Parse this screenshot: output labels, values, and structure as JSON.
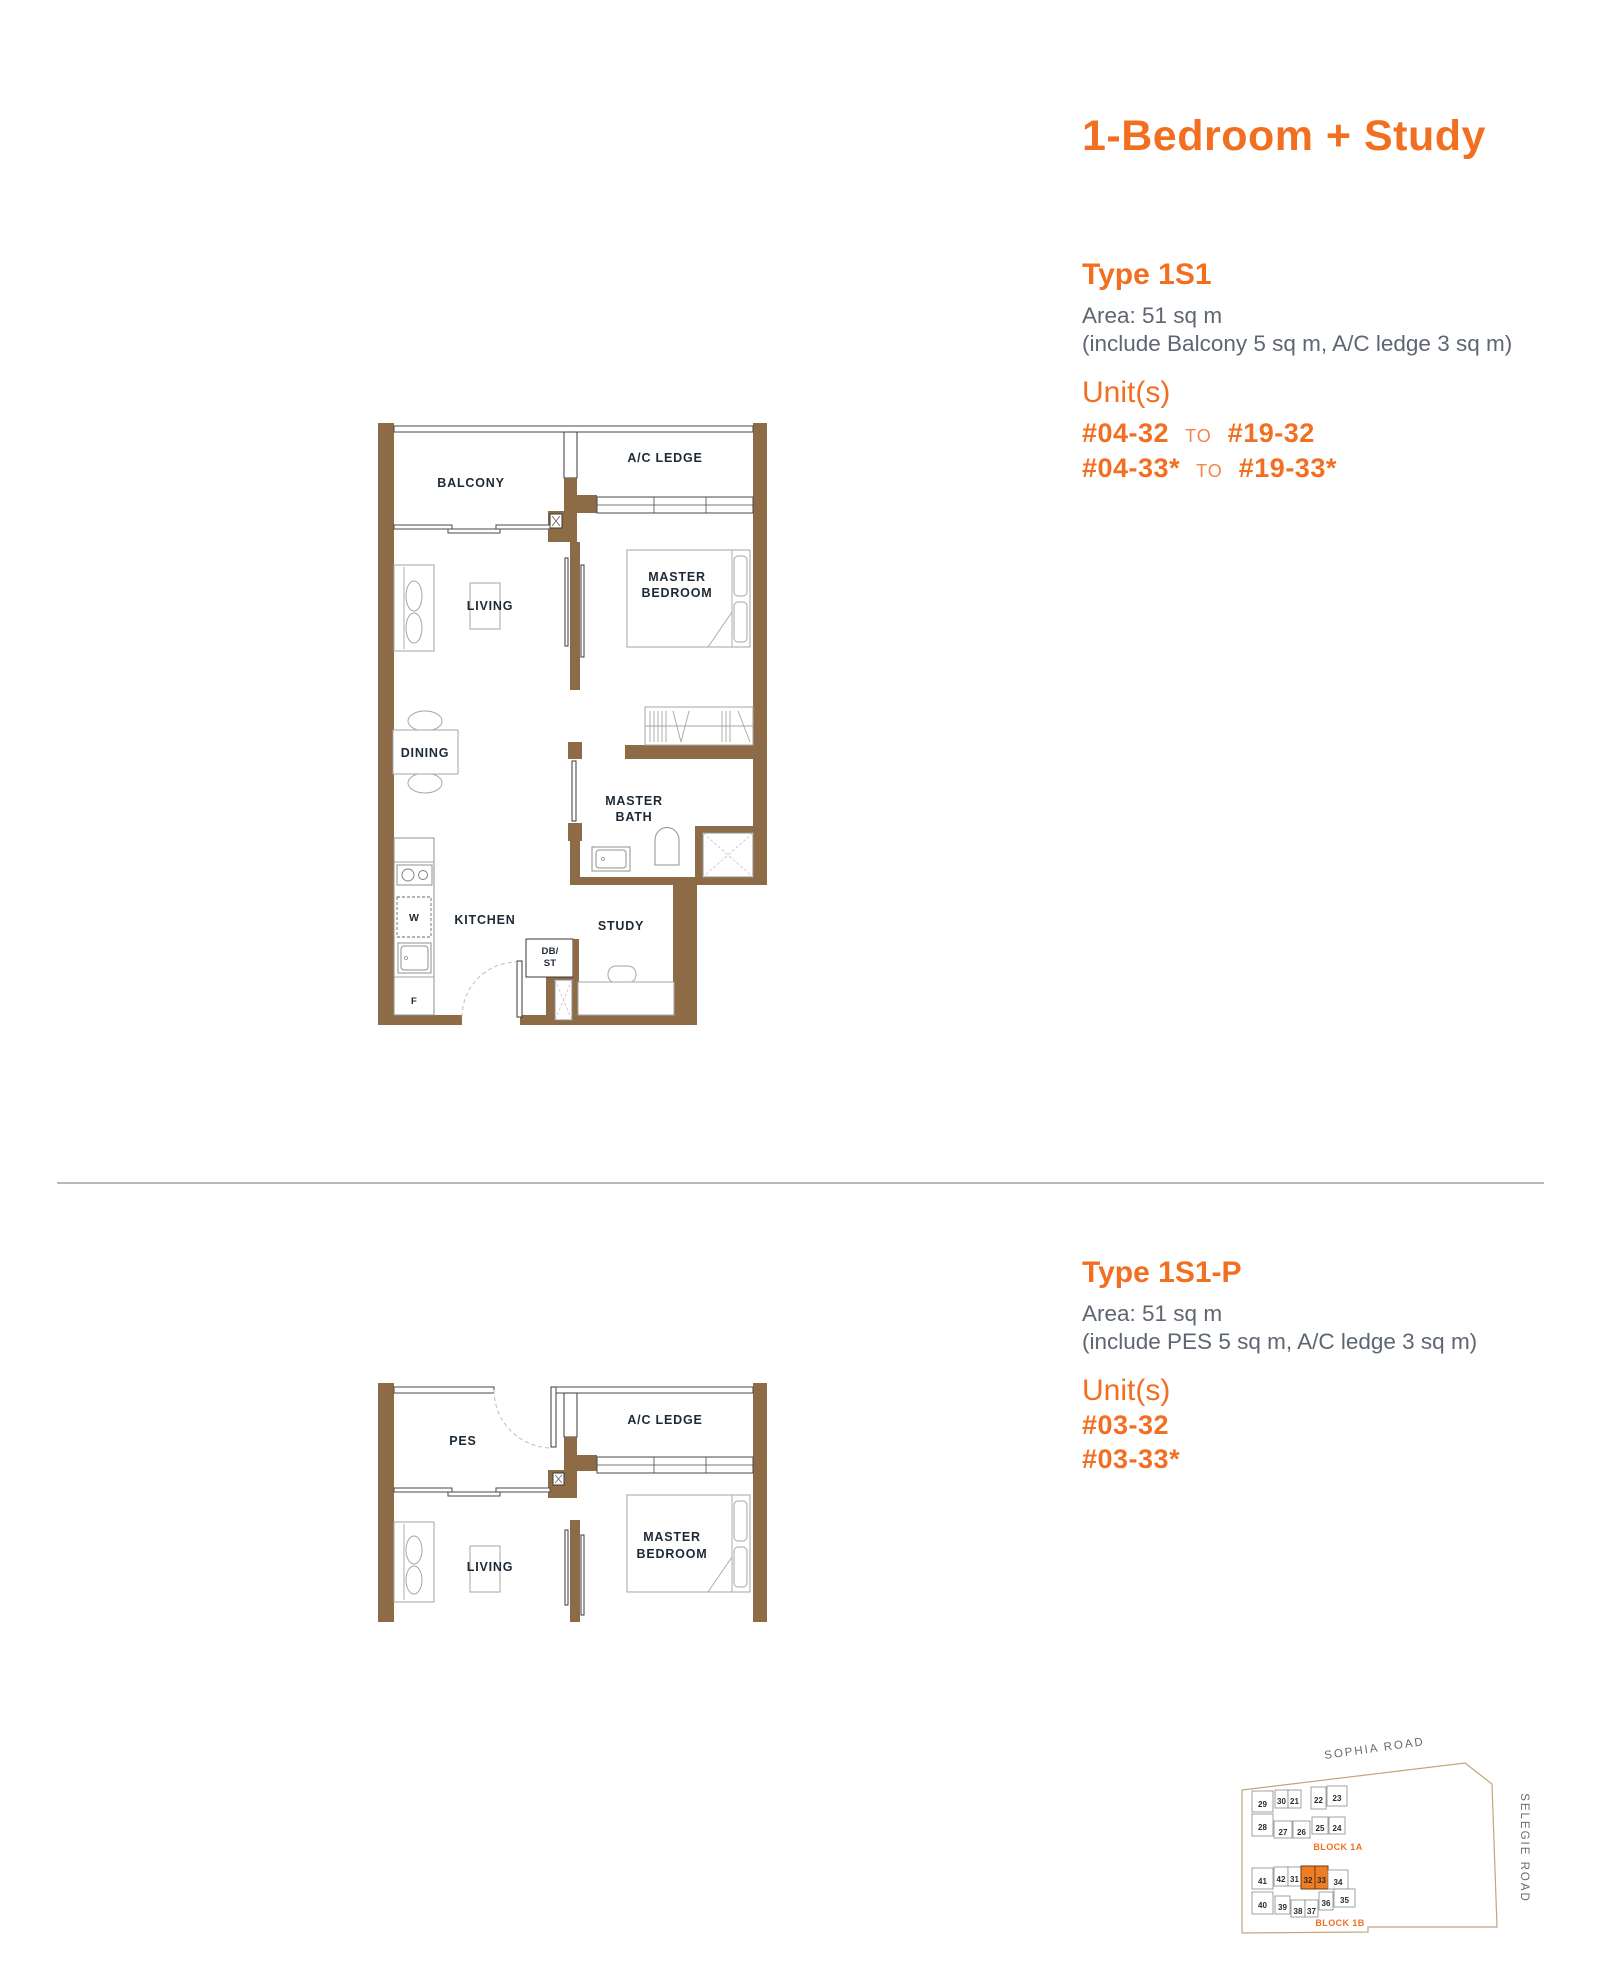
{
  "page": {
    "title": "1-Bedroom + Study"
  },
  "colors": {
    "accent_orange": "#f26f21",
    "wall_brown": "#8d6b46",
    "body_gray": "#5d6672",
    "plan_label": "#1d2a36",
    "highlight_unit": "#ef7d23"
  },
  "type1": {
    "heading": "Type 1S1",
    "area_line1": "Area: 51 sq m",
    "area_line2": "(include Balcony 5 sq m, A/C ledge 3 sq m)",
    "units_heading": "Unit(s)",
    "unit_rows": [
      {
        "from": "#04-32",
        "to_word": "TO",
        "to": "#19-32"
      },
      {
        "from": "#04-33*",
        "to_word": "TO",
        "to": "#19-33*"
      }
    ]
  },
  "type2": {
    "heading": "Type 1S1-P",
    "area_line1": "Area: 51 sq m",
    "area_line2": "(include PES 5 sq m, A/C ledge 3 sq m)",
    "units_heading": "Unit(s)",
    "unit_rows": [
      {
        "from": "#03-32"
      },
      {
        "from": "#03-33*"
      }
    ]
  },
  "plan1": {
    "balcony": "BALCONY",
    "ac_ledge": "A/C LEDGE",
    "living": "LIVING",
    "master_line1": "MASTER",
    "master_line2": "BEDROOM",
    "dining": "DINING",
    "bath_line1": "MASTER",
    "bath_line2": "BATH",
    "kitchen": "KITCHEN",
    "study": "STUDY",
    "db_line1": "DB/",
    "db_line2": "ST",
    "washer": "W",
    "fridge": "F"
  },
  "plan2": {
    "pes": "PES",
    "ac_ledge": "A/C LEDGE",
    "living": "LIVING",
    "master_line1": "MASTER",
    "master_line2": "BEDROOM"
  },
  "sitemap": {
    "road_top": "SOPHIA ROAD",
    "road_right": "SELEGIE ROAD",
    "block_1a": {
      "label": "BLOCK 1A",
      "row1": [
        "29",
        "30",
        "21",
        "22",
        "23"
      ],
      "row2": [
        "28",
        "27",
        "26",
        "25",
        "24"
      ]
    },
    "block_1b": {
      "label": "BLOCK 1B",
      "row1": [
        "41",
        "42",
        "31",
        "32",
        "33",
        "34"
      ],
      "row2": [
        "40",
        "39",
        "38",
        "37",
        "36",
        "35"
      ],
      "highlighted_units": [
        "32",
        "33"
      ]
    }
  }
}
